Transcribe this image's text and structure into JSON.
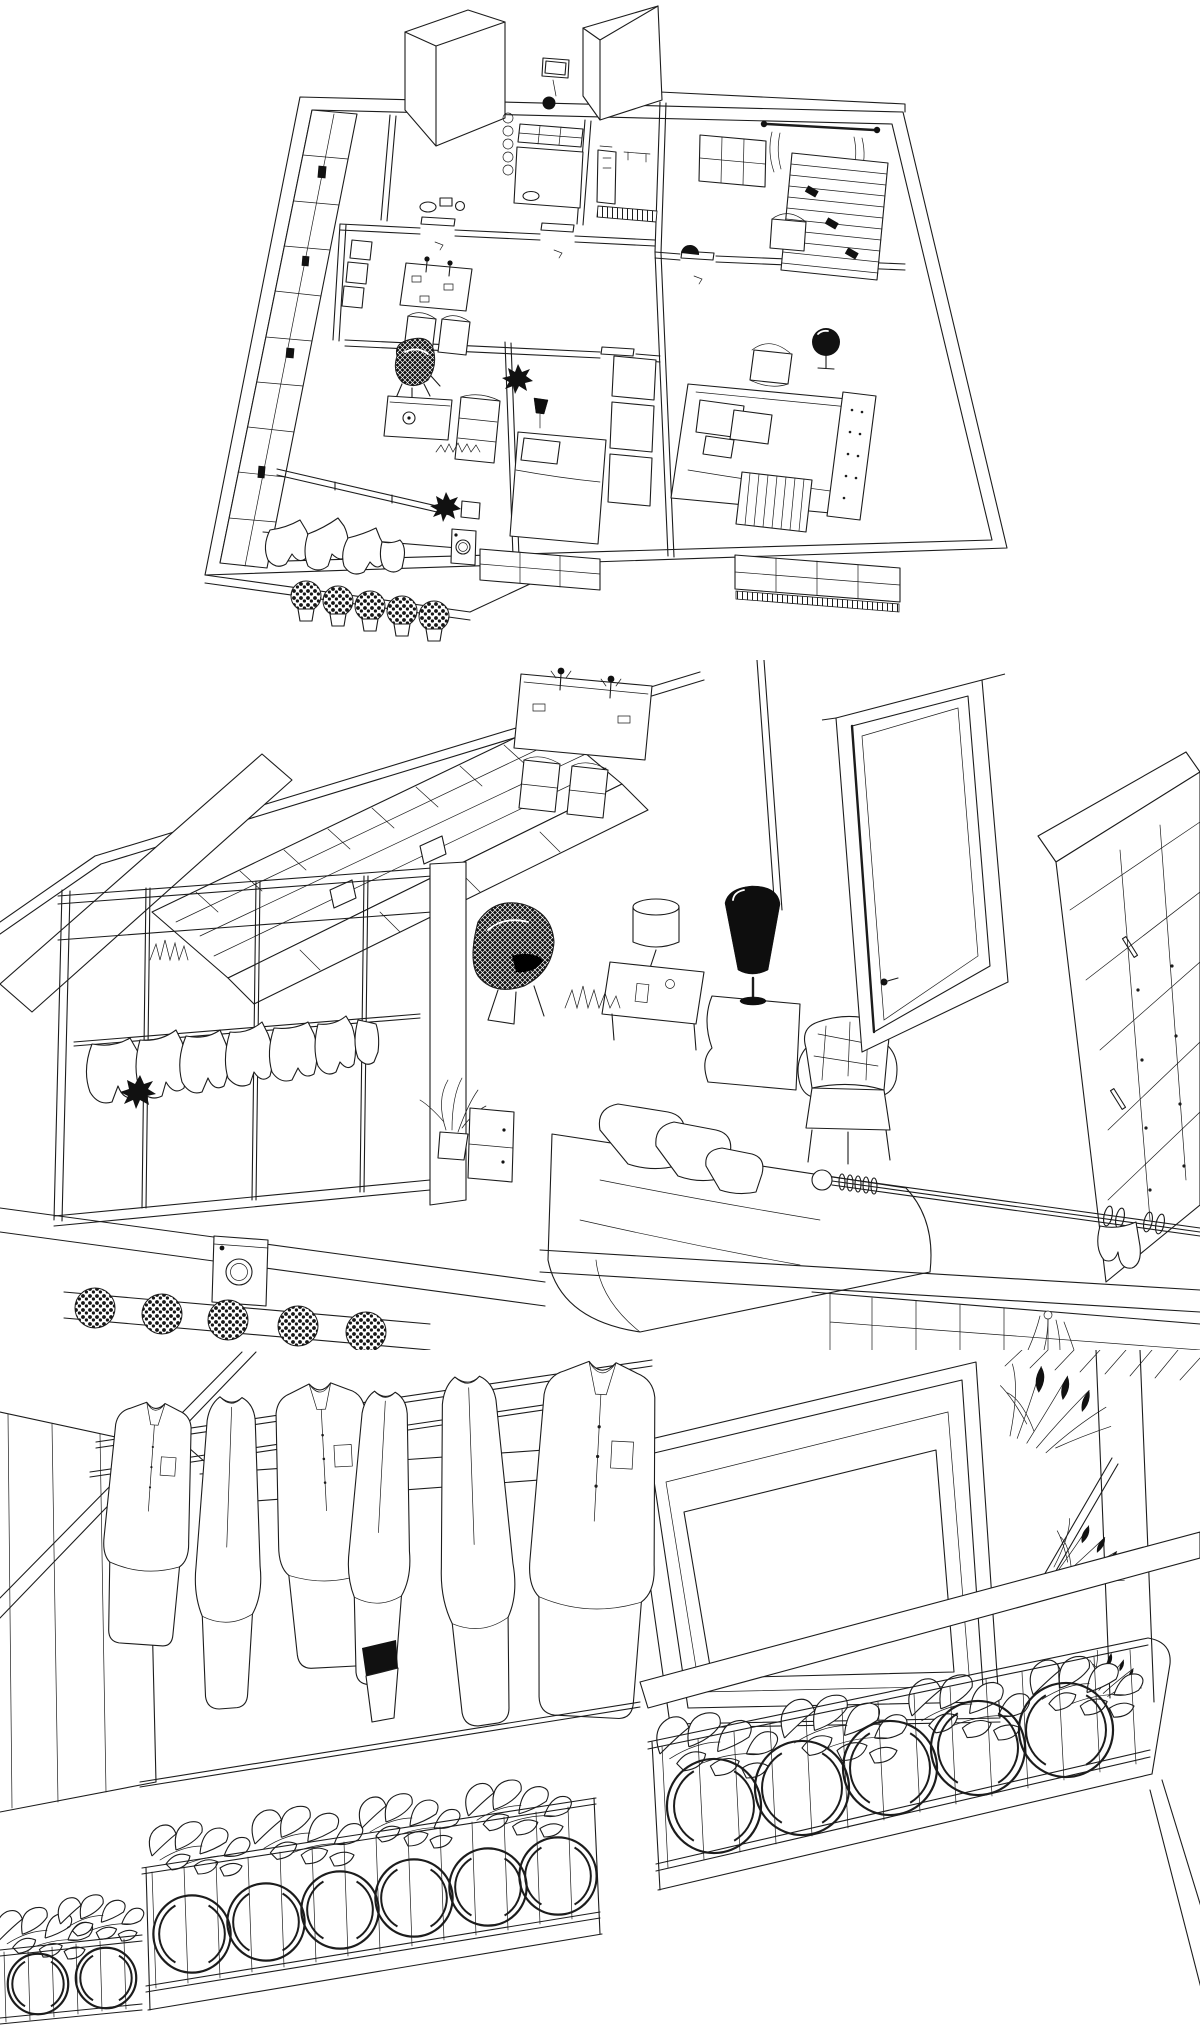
{
  "meta": {
    "title": "3D interior wireframe rendering",
    "medium": "black-and-white architectural line drawing, three stacked views",
    "canvas": {
      "width": 1200,
      "height": 2025
    }
  },
  "style": {
    "paper": "#ffffff",
    "ink": "#1c1c1c",
    "solid_black": "#111111"
  },
  "panels": [
    {
      "id": "floor-plan-overview",
      "label": "Axonometric cutaway floor plan of an apartment: kitchen with dish shelves and drawers, bathroom with shower, nursery with curtained window and slatted wardrobe, master bedroom with bed, armchair, black sphere lamp and crib, second bedroom, living-dining room with bookshelf wall, dining table, wire-mesh lounge chair, coffee table and sofa, balcony with drying laundry, washing machine and five hydrangea flower boxes"
    },
    {
      "id": "interior-perspective",
      "label": "Perspective view into the apartment: bookshelf wall, dining table with candlesticks and chairs, wire-mesh ball chair, desk with cylinder lamp, black cone floor lamp on side table, tufted armchair, open paneled door, tall chest of drawers, bed with pillows, curtain rod with finial, balcony with window wall, hanging laundry, washing machine, potted plant and hydrangea window boxes"
    },
    {
      "id": "balcony-closeup",
      "label": "Close-up of the balcony: wardrobe at left, drying rail with hanging shirts and garments, large framed window, hanging plants at right, and long planter boxes full of leaves over ornamental railing with circle motifs"
    }
  ]
}
